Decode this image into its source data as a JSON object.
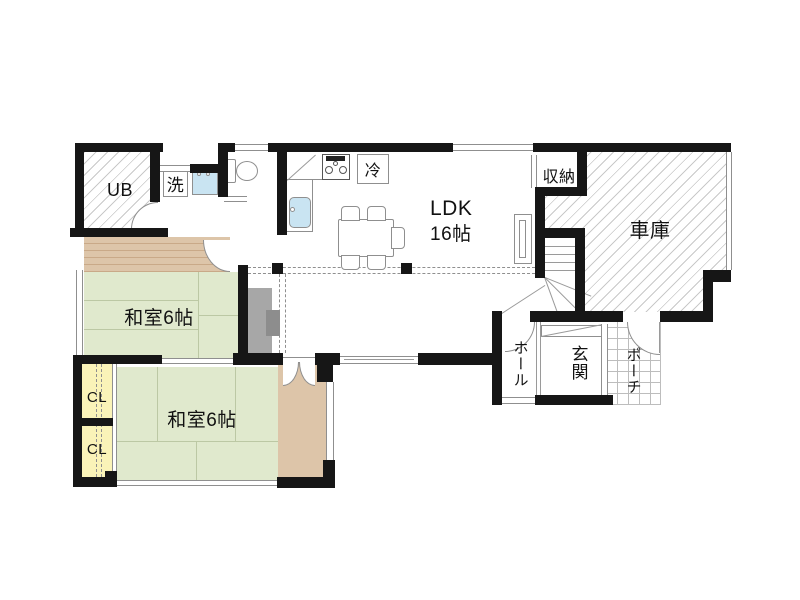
{
  "colors": {
    "wall": "#161616",
    "line": "#8f8f8f",
    "thin": "#9a9a9a",
    "tatami": "#e0e9cd",
    "tatami_line": "#bcc8a4",
    "wood": "#ddc5a9",
    "wood_line": "#c9a988",
    "closet": "#faf3b8",
    "water": "#c9e4f2",
    "furn": "#a7a7a7",
    "furn_dark": "#8d8d8d",
    "hatch": "#c9c9c9",
    "grid": "#bdbdbd"
  },
  "rooms": {
    "ub": {
      "label": "UB"
    },
    "laundry": {
      "label": "洗"
    },
    "ldk": {
      "label": "LDK",
      "size": "16帖"
    },
    "fridge": {
      "label": "冷"
    },
    "storage": {
      "label": "収納"
    },
    "garage": {
      "label": "車庫"
    },
    "washitsu_upper": {
      "label": "和室6帖"
    },
    "washitsu_lower": {
      "label": "和室6帖"
    },
    "closet_upper": {
      "label": "CL"
    },
    "closet_lower": {
      "label": "CL"
    },
    "hall": {
      "label": "ホール"
    },
    "entrance": {
      "label": "玄関"
    },
    "porch": {
      "label": "ポーチ"
    }
  }
}
